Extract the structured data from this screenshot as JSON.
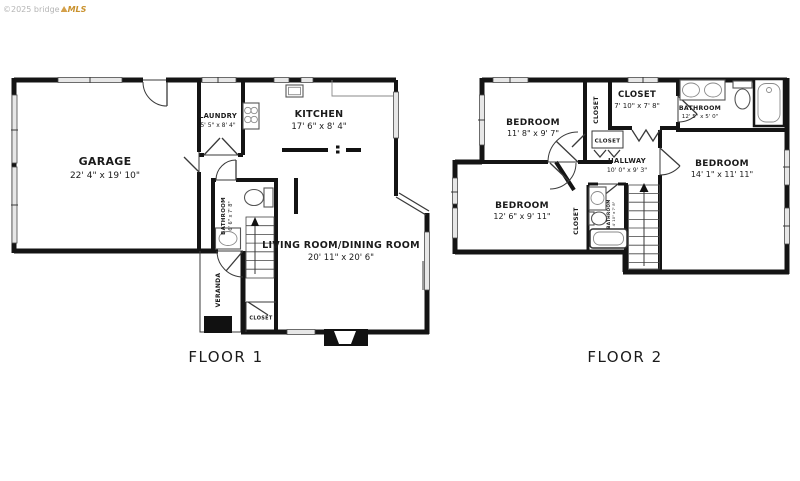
{
  "watermark": {
    "copyright": "©2025 bridge",
    "brand": "MLS"
  },
  "colors": {
    "walls": "#141414",
    "windows": "#e7e7e7",
    "brand_orange": "#c9912c",
    "watermark_gray": "#b5b5b5"
  },
  "floor1": {
    "caption": "FLOOR 1",
    "garage": {
      "name": "GARAGE",
      "dims": "22' 4\" x 19' 10\""
    },
    "laundry": {
      "name": "LAUNDRY",
      "dims": "5' 5\" x 8' 4\""
    },
    "kitchen": {
      "name": "KITCHEN",
      "dims": "17' 6\" x 8' 4\""
    },
    "bathroom": {
      "name": "BATHROOM",
      "dims": "6' 6\" x 7' 8\""
    },
    "living_dining": {
      "name": "LIVING ROOM/DINING ROOM",
      "dims": "20' 11\" x 20' 6\""
    },
    "veranda": {
      "name": "VERANDA"
    },
    "closet": {
      "name": "CLOSET"
    }
  },
  "floor2": {
    "caption": "FLOOR 2",
    "bedroom_top_left": {
      "name": "BEDROOM",
      "dims": "11' 8\" x 9' 7\""
    },
    "closet_bedroom_top": {
      "name": "CLOSET"
    },
    "closet_walk_in": {
      "name": "CLOSET",
      "dims": "7' 10\" x 7' 8\""
    },
    "bathroom_main": {
      "name": "BATHROOM",
      "dims": "12' 5\" x 5' 0\""
    },
    "closet_hall": {
      "name": "CLOSET"
    },
    "hallway": {
      "name": "HALLWAY",
      "dims": "10' 0\" x 9' 3\""
    },
    "bedroom_right": {
      "name": "BEDROOM",
      "dims": "14' 1\" x 11' 11\""
    },
    "bedroom_bottom_left": {
      "name": "BEDROOM",
      "dims": "12' 6\" x 9' 11\""
    },
    "closet_bedroom_bottom": {
      "name": "CLOSET"
    },
    "bathroom_small": {
      "name": "BATHROOM",
      "dims": "4' 10\" x 7' 8\""
    }
  }
}
